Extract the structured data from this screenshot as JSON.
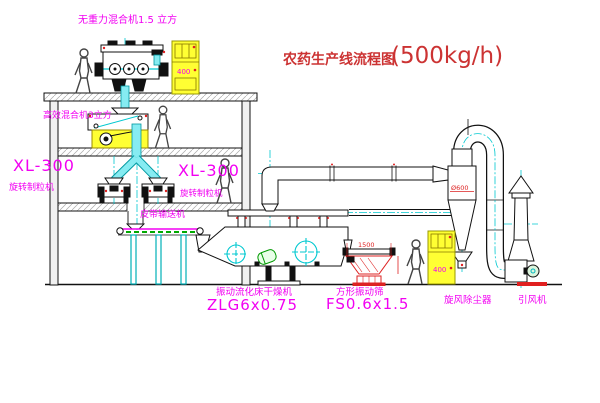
{
  "title": {
    "name": "农药生产线流程图",
    "capacity": "(500kg/h)"
  },
  "labels": {
    "gravity_free_mixer": "无重力混合机1.5 立方",
    "high_efficiency_mixer": "高效混合机3立方",
    "granulator_left_model": "XL-300",
    "granulator_left_name": "旋转制粒机",
    "granulator_right_model": "XL-300",
    "granulator_right_name": "旋转制粒机",
    "belt_conveyor": "皮带输送机",
    "dryer_name": "振动流化床干燥机",
    "dryer_model": "ZLG6x0.75",
    "sieve_name": "方形振动筛",
    "sieve_model": "FS0.6x1.5",
    "cyclone_name": "旋风除尘器",
    "fan_name": "引风机"
  },
  "dimensions": {
    "cabinet_top": "400",
    "cabinet_right": "400",
    "cyclone_diameter": "Ø600",
    "sieve_width": "1500"
  },
  "colors": {
    "label_magenta": "#f200f2",
    "title_red": "#cc3333",
    "dimension_red": "#dd2222",
    "pipe_cyan": "#00c8d0",
    "cabinet_yellow": "#ffff33"
  }
}
